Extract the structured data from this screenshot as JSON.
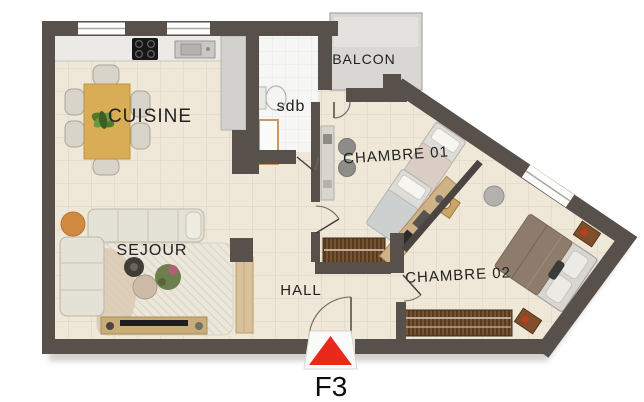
{
  "plan": {
    "name": "apartment-floor-plan",
    "type": "2D architectural floor plan, top view"
  },
  "rooms": {
    "cuisine": {
      "label": "CUISINE",
      "furniture": [
        "dining table",
        "six chairs",
        "plant centerpiece",
        "cooktop",
        "sink",
        "worktop counter",
        "side counter"
      ]
    },
    "sejour": {
      "label": "SEJOUR",
      "furniture": [
        "corner sofa",
        "round side table",
        "rug",
        "coffee tables",
        "plant",
        "tv console"
      ]
    },
    "hall": {
      "label": "HALL",
      "furniture": [
        "tall cabinet",
        "entrance door"
      ]
    },
    "sdb": {
      "label": "sdb",
      "furniture": [
        "toilet",
        "shower"
      ]
    },
    "balcon": {
      "label": "BALCON",
      "furniture": []
    },
    "chambre01": {
      "label": "CHAMBRE 01",
      "furniture": [
        "single bed",
        "single bed",
        "nightstand with lamp",
        "desk",
        "two chairs",
        "wardrobe"
      ]
    },
    "chambre02": {
      "label": "CHAMBRE 02",
      "furniture": [
        "double bed",
        "two nightstands",
        "wardrobe",
        "desk",
        "stool"
      ]
    }
  },
  "entrance_marker": {
    "label": "F3",
    "arrow_color": "#e8291c"
  },
  "colors": {
    "wall": "#57504b",
    "floor_tile": "#efe8d9",
    "bathroom_floor": "#f6f6f4",
    "balcony_floor": "#d8d7d4",
    "wood_table": "#d9ad56",
    "wardrobe_wood": "#6f4c2c",
    "marker_red": "#e8291c"
  }
}
